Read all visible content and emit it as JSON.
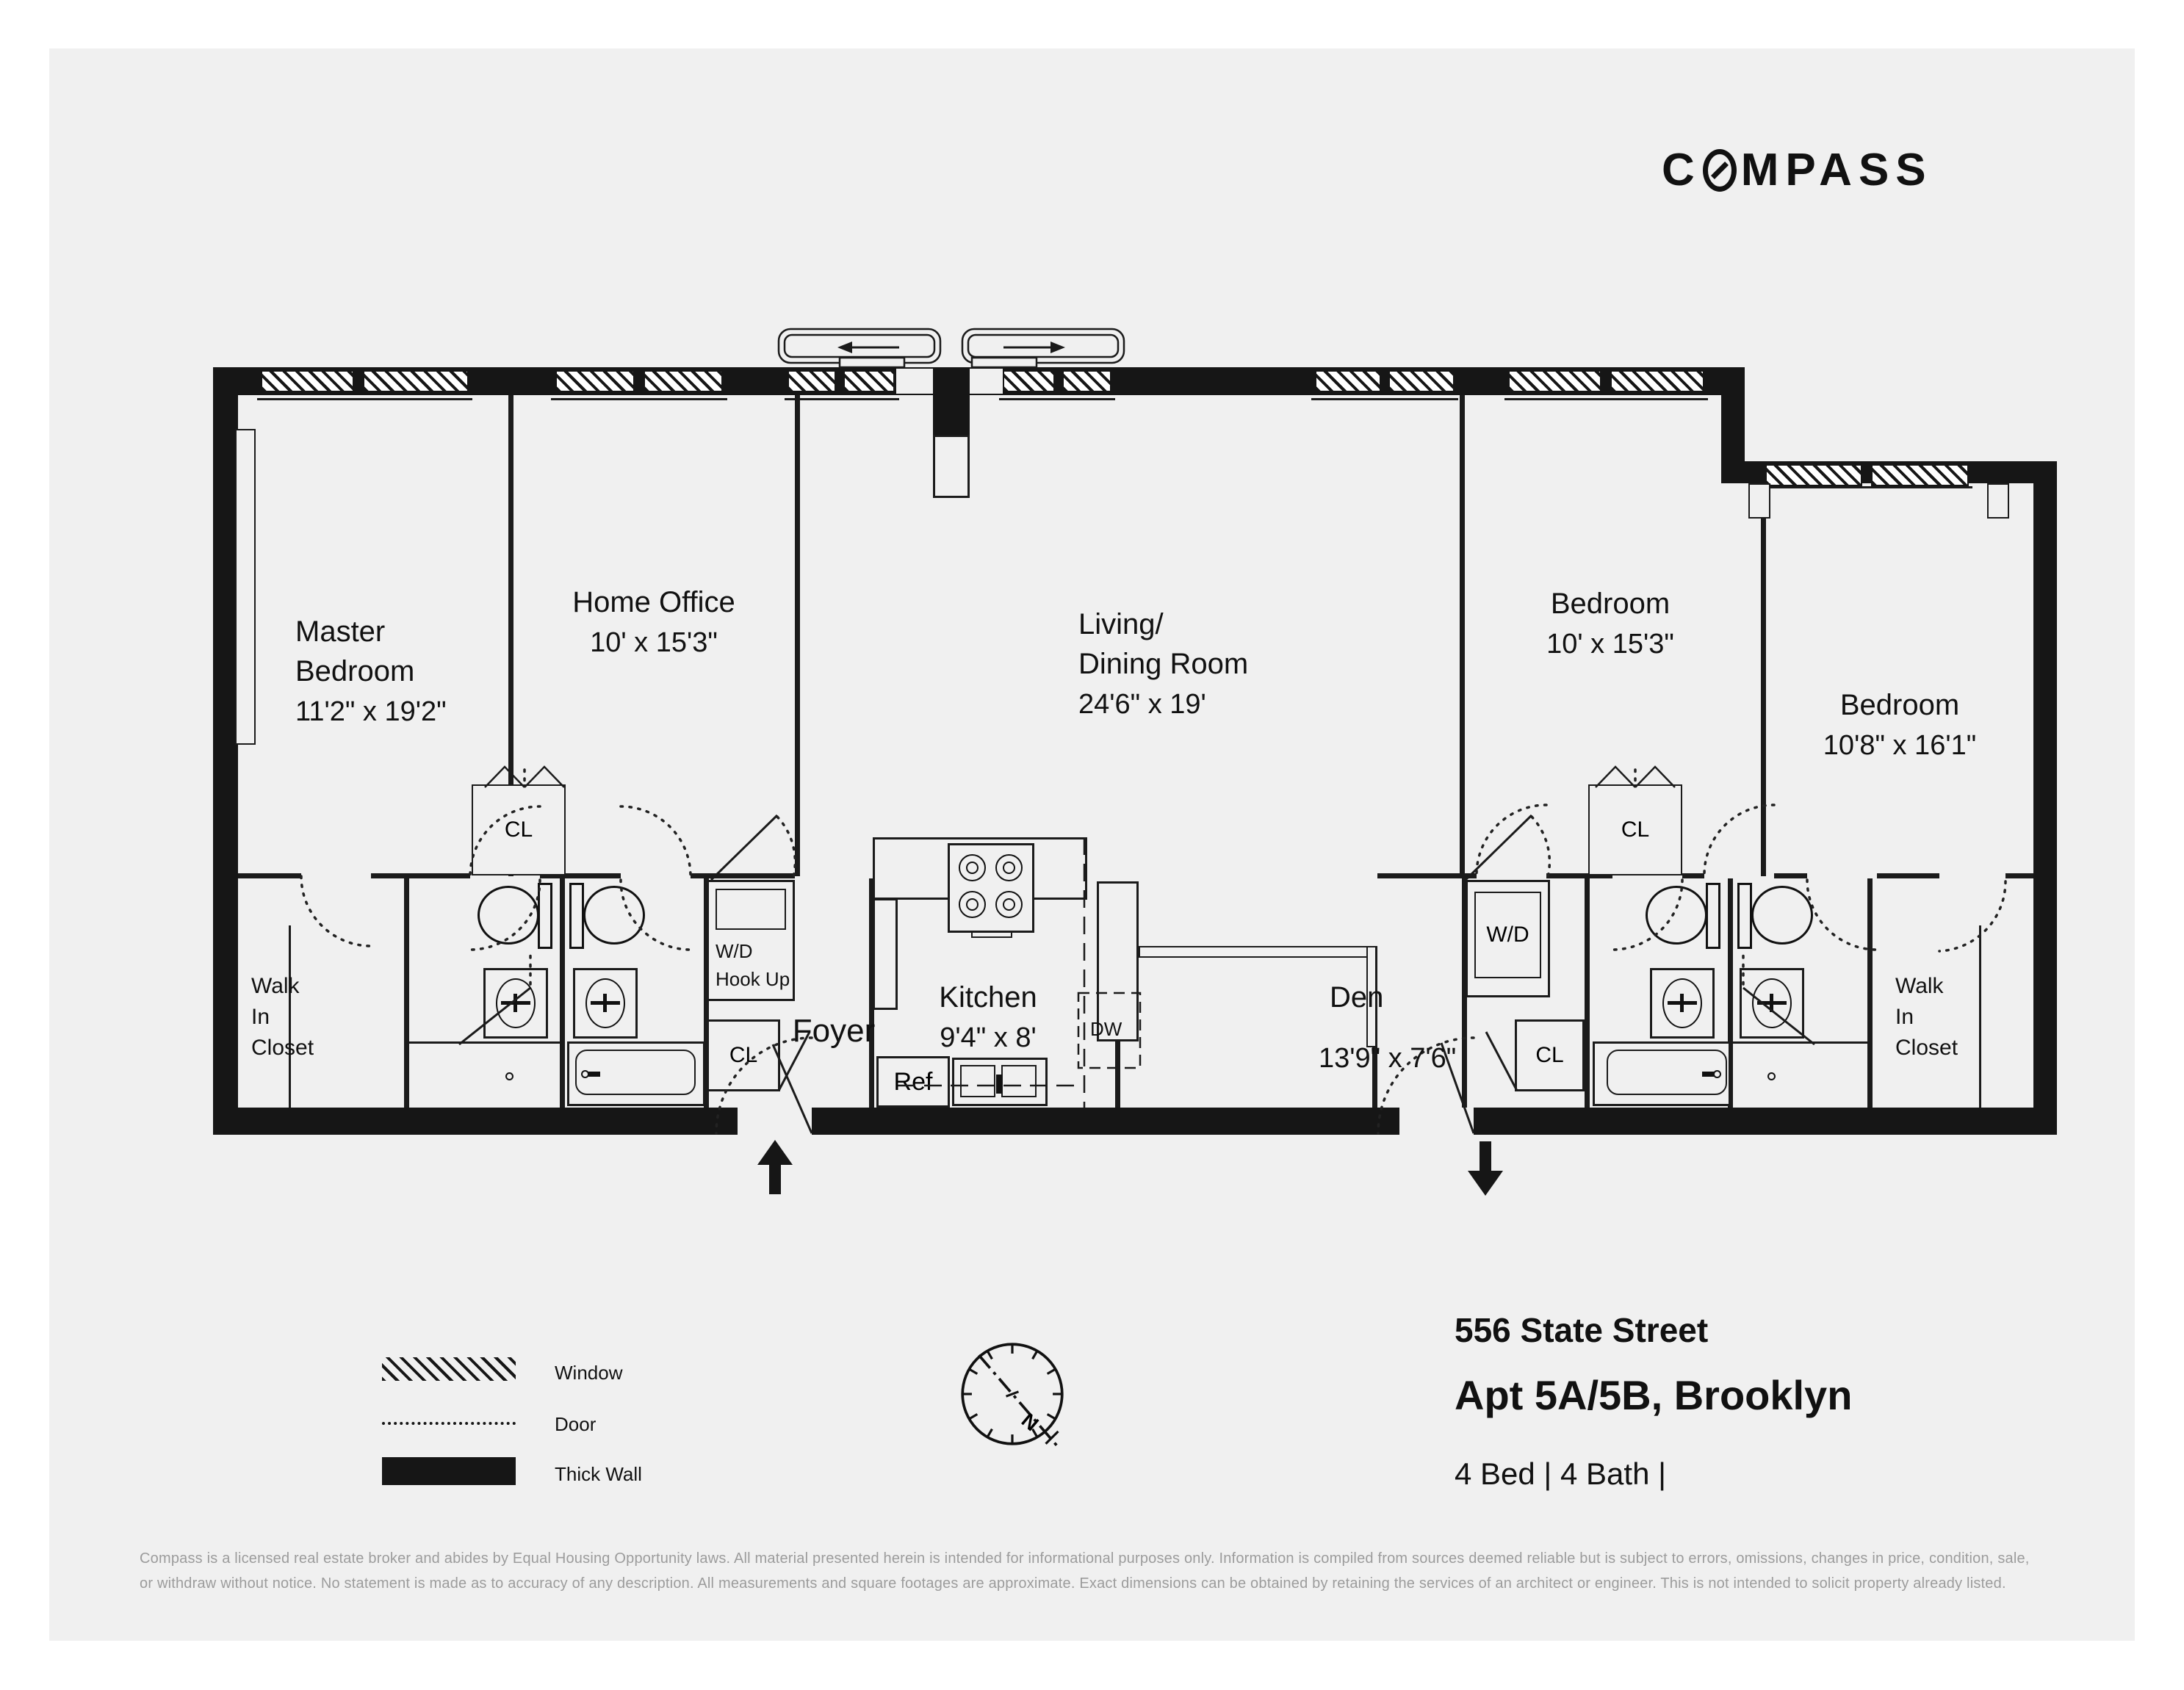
{
  "logo": {
    "pre": "C",
    "post": "MPASS"
  },
  "rooms": {
    "master": {
      "l1": "Master",
      "l2": "Bedroom",
      "dims": "11'2\" x 19'2\""
    },
    "home_office": {
      "name": "Home Office",
      "dims": "10' x 15'3\""
    },
    "living": {
      "l1": "Living/",
      "l2": "Dining Room",
      "dims": "24'6\" x 19'"
    },
    "bedroom3": {
      "name": "Bedroom",
      "dims": "10' x 15'3\""
    },
    "bedroom4": {
      "name": "Bedroom",
      "dims": "10'8\" x 16'1\""
    },
    "kitchen": {
      "name": "Kitchen",
      "dims": "9'4\" x 8'"
    },
    "den": {
      "name": "Den",
      "dims": "13'9\" x 7'6\""
    },
    "foyer": "Foyer",
    "walk_in_closet": {
      "l1": "Walk",
      "l2": "In",
      "l3": "Closet"
    },
    "wd_hookup": {
      "l1": "W/D",
      "l2": "Hook Up"
    },
    "wd": "W/D",
    "cl": "CL",
    "ref": "Ref",
    "dw": "DW"
  },
  "legend": {
    "window": "Window",
    "door": "Door",
    "thick_wall": "Thick Wall"
  },
  "compass": {
    "north": "N"
  },
  "address": {
    "street": "556 State Street",
    "unit": "Apt 5A/5B, Brooklyn",
    "meta": "4 Bed | 4 Bath |"
  },
  "disclaimer": {
    "line1": "Compass is a licensed real estate broker and abides by Equal Housing Opportunity laws. All material presented herein is intended for informational purposes only. Information is compiled from sources deemed reliable but is subject to errors, omissions, changes in price, condition, sale,",
    "line2": "or withdraw without notice. No statement is made as to accuracy of any description. All measurements and square footages are approximate. Exact dimensions can be obtained by retaining the services of an architect or engineer. This is not intended to solicit property already listed."
  }
}
